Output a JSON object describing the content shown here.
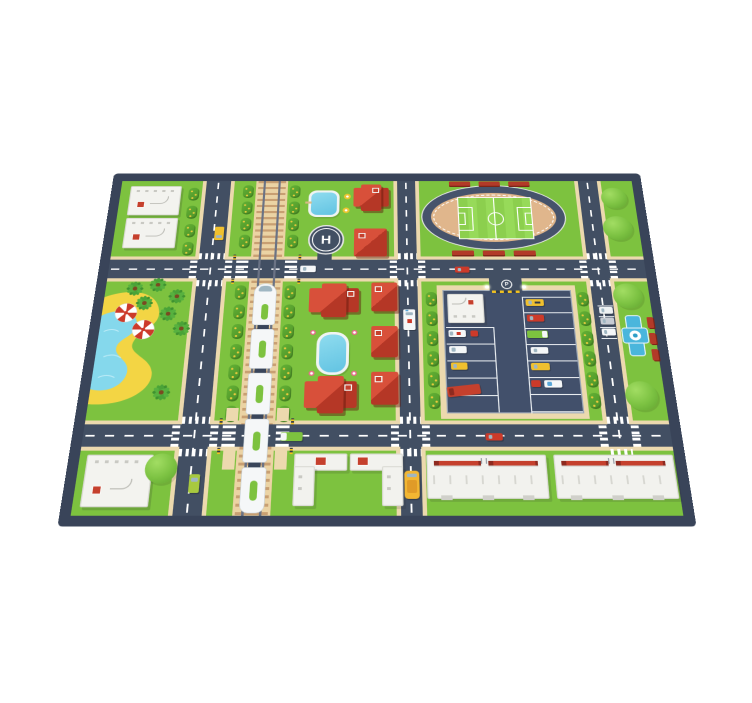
{
  "meta": {
    "scene": "Children's city play-mat shown in perspective on a white background",
    "background": "#ffffff"
  },
  "palette": {
    "mat_border": "#394459",
    "road": "#424f63",
    "road_marking": "#ffffff",
    "grass": "#7dc23f",
    "path_tan": "#ecd9ae",
    "rail_bed_tan": "#ebd3a4",
    "roof_red": "#c5402d",
    "roof_red_dark": "#8e2a1f",
    "building_white": "#f2f2ee",
    "water_blue": "#7fd4ec",
    "sand_yellow": "#f3d544",
    "vehicle_yellow": "#f0c02e",
    "hedge_green": "#56a22e",
    "stadium_infield": "#e0b68c",
    "fountain_blue": "#4ab6dc",
    "barrier_yellow": "#f2c21f"
  },
  "labels": {
    "helipad_letter": "H",
    "parking_sign_letter": "P"
  },
  "inventory": {
    "blocks": [
      "courts-block-top-left",
      "pond-and-houses-block",
      "stadium-block",
      "beach-lagoon-block",
      "houses-and-pool-block",
      "parking-lot-block",
      "promenade-column-right",
      "school-block-bottom-left",
      "l-buildings-block",
      "shopping-centers-block",
      "railway-corridor"
    ],
    "features": {
      "red_roof_houses": 7,
      "white_court_pads": 3,
      "l_shaped_buildings": 2,
      "long_white_buildings": 2,
      "stadium_benches": 6,
      "beach_umbrellas": 2,
      "palm_trees": 7,
      "round_trees": 6,
      "train_cars": 5,
      "helipad": 1,
      "fountain": 1,
      "swimming_pools": 2
    },
    "vehicles": [
      {
        "name": "taxi",
        "color": "yellow",
        "location": "north avenue"
      },
      {
        "name": "white-car",
        "color": "white",
        "location": "first cross street"
      },
      {
        "name": "red-car",
        "color": "red",
        "location": "first cross street east"
      },
      {
        "name": "ambulance",
        "color": "white",
        "location": "central avenue"
      },
      {
        "name": "red-car",
        "color": "red",
        "location": "second cross street"
      },
      {
        "name": "green-truck",
        "color": "green",
        "location": "second cross street west"
      },
      {
        "name": "green-car",
        "color": "green",
        "location": "south avenue"
      },
      {
        "name": "school-bus",
        "color": "yellow",
        "location": "central avenue south"
      },
      {
        "name": "parked-cars",
        "color": "white/gray",
        "location": "east avenue bays"
      },
      {
        "name": "parked-cars-lot",
        "color": "mixed",
        "location": "parking lot"
      }
    ]
  }
}
